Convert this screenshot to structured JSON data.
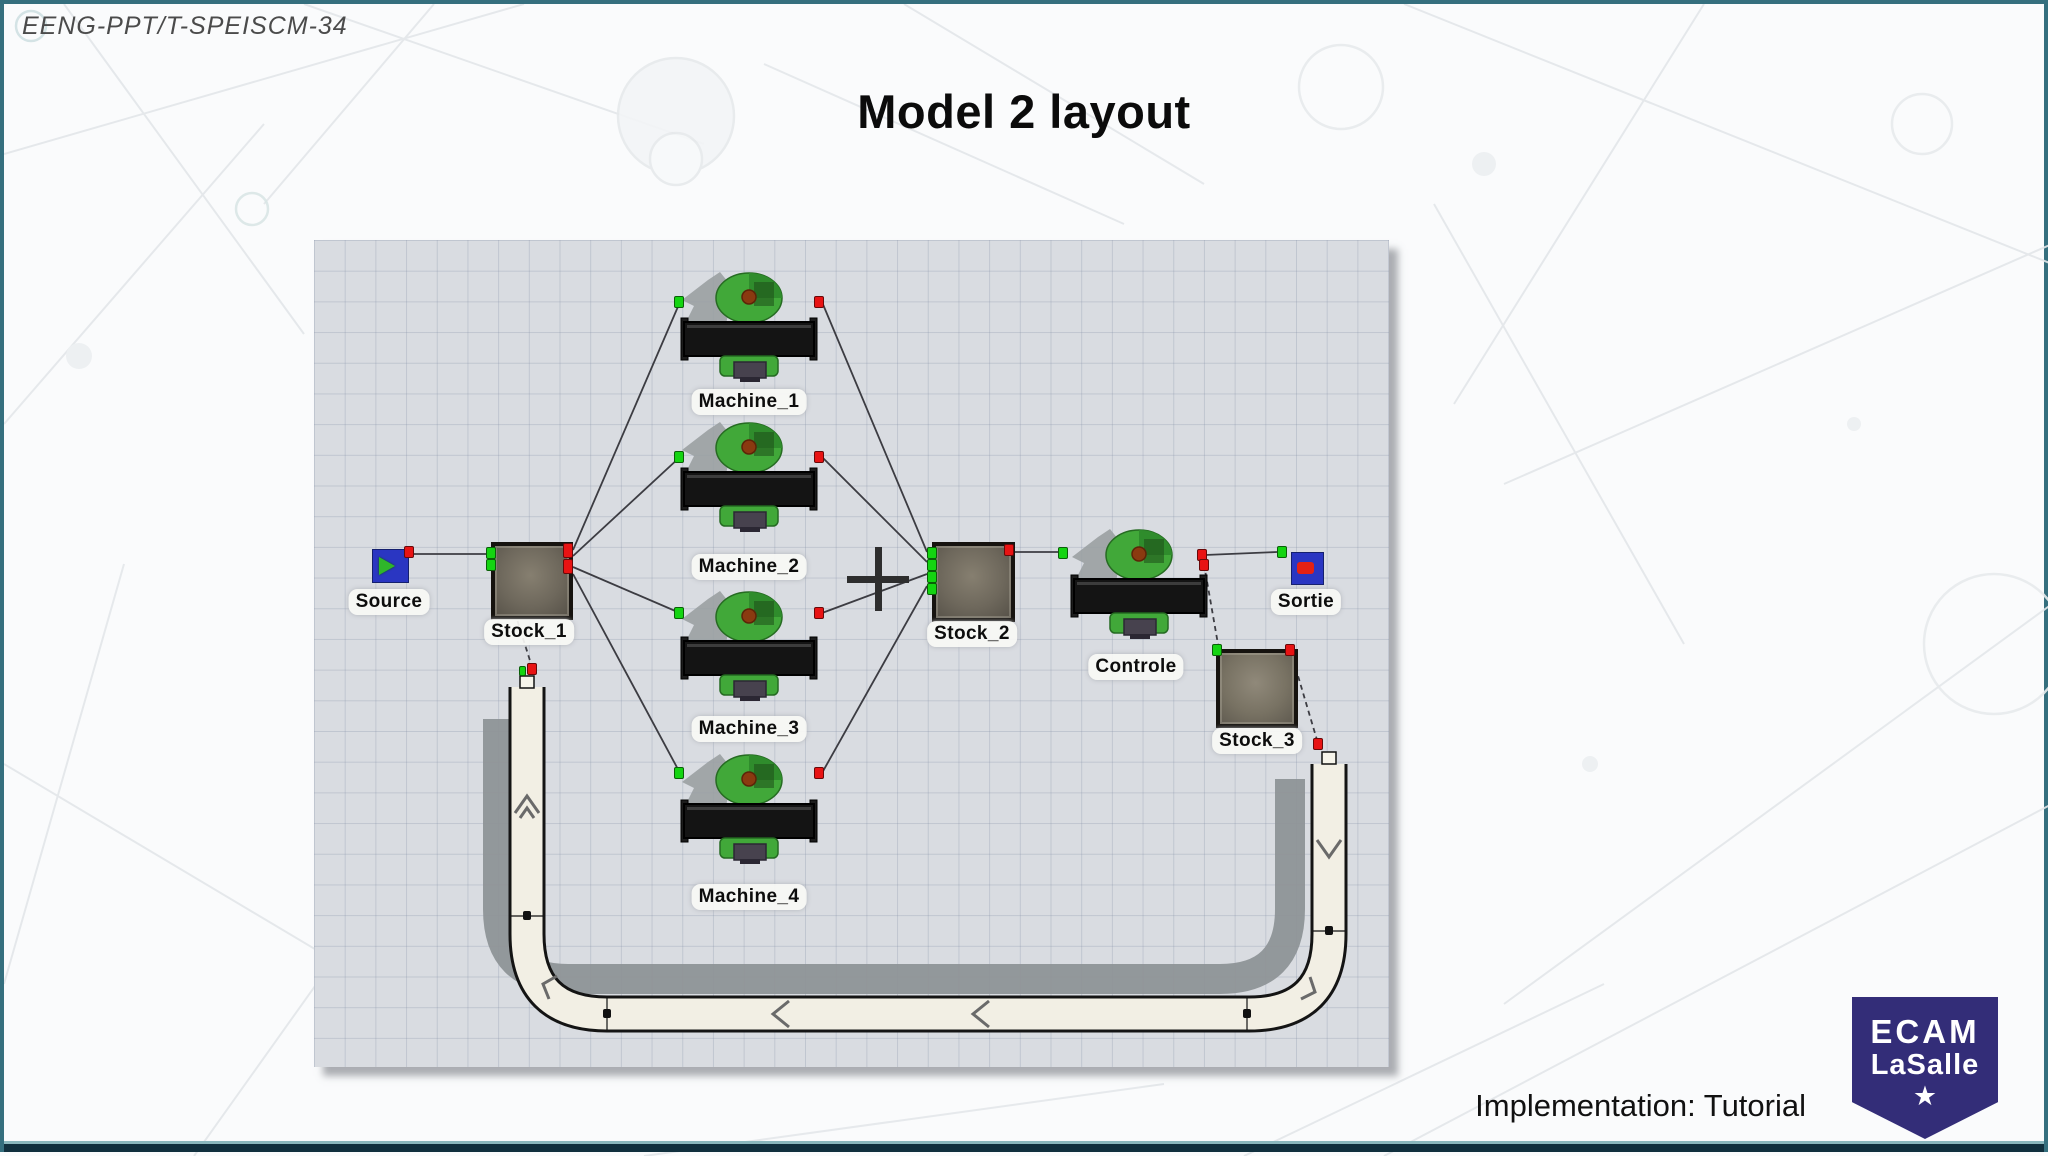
{
  "slide": {
    "course_code": "EENG-PPT/T-SPEISCM-34",
    "title": "Model 2 layout",
    "footer_note": "Implementation: Tutorial",
    "logo": {
      "line1": "ECAM",
      "line2": "LaSalle",
      "star": "★",
      "bg_color": "#332d78"
    }
  },
  "canvas": {
    "description": "Plant-simulation model layout with a grid worksheet, material-flow stations and a U-shaped return conveyor loop",
    "nodes": {
      "source": {
        "label": "Source",
        "type": "source"
      },
      "stock_1": {
        "label": "Stock_1",
        "type": "store"
      },
      "machine_1": {
        "label": "Machine_1",
        "type": "machine"
      },
      "machine_2": {
        "label": "Machine_2",
        "type": "machine"
      },
      "machine_3": {
        "label": "Machine_3",
        "type": "machine"
      },
      "machine_4": {
        "label": "Machine_4",
        "type": "machine"
      },
      "stock_2": {
        "label": "Stock_2",
        "type": "store"
      },
      "controle": {
        "label": "Controle",
        "type": "machine"
      },
      "sortie": {
        "label": "Sortie",
        "type": "drain"
      },
      "stock_3": {
        "label": "Stock_3",
        "type": "store"
      }
    },
    "connections": [
      {
        "from": "Source",
        "to": "Stock_1",
        "style": "solid"
      },
      {
        "from": "Stock_1",
        "to": "Machine_1",
        "style": "solid"
      },
      {
        "from": "Stock_1",
        "to": "Machine_2",
        "style": "solid"
      },
      {
        "from": "Stock_1",
        "to": "Machine_3",
        "style": "solid"
      },
      {
        "from": "Stock_1",
        "to": "Machine_4",
        "style": "solid"
      },
      {
        "from": "Machine_1",
        "to": "Stock_2",
        "style": "solid"
      },
      {
        "from": "Machine_2",
        "to": "Stock_2",
        "style": "solid"
      },
      {
        "from": "Machine_3",
        "to": "Stock_2",
        "style": "solid"
      },
      {
        "from": "Machine_4",
        "to": "Stock_2",
        "style": "solid"
      },
      {
        "from": "Stock_2",
        "to": "Controle",
        "style": "solid"
      },
      {
        "from": "Controle",
        "to": "Sortie",
        "style": "solid"
      },
      {
        "from": "Controle",
        "to": "Stock_3",
        "style": "dashed"
      },
      {
        "from": "Stock_3",
        "to": "conveyor-loop",
        "style": "dashed"
      },
      {
        "from": "Stock_1",
        "to": "conveyor-loop",
        "style": "dashed"
      }
    ],
    "colors": {
      "grid_bg": "#d9dce1",
      "grid_line": "#8792a8",
      "conveyor_fill": "#f2efe4",
      "conveyor_outline": "#141414",
      "shadow_gray": "#8e9497",
      "machine_green": "#41a839",
      "input_port": "#14d411",
      "output_port": "#e81313",
      "source_blue": "#2a36c2"
    }
  }
}
